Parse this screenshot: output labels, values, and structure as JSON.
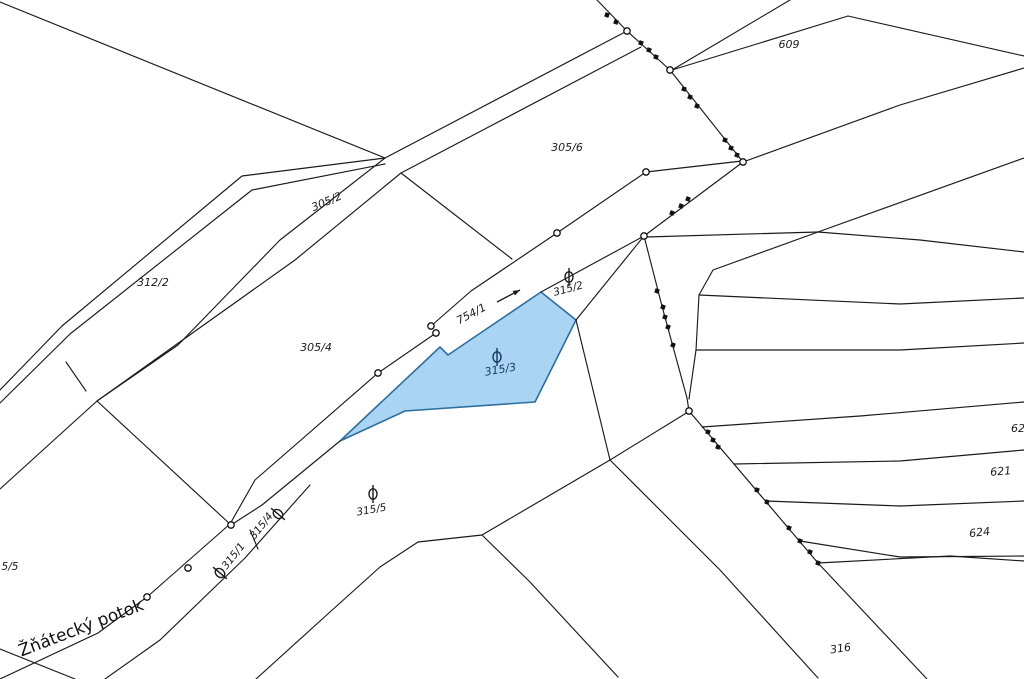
{
  "map": {
    "title": "cadastral-map",
    "background": "#ffffff",
    "line_color": "#1a1a1a",
    "highlight_parcel": {
      "id": "315/3",
      "fill": "#a9d4f3",
      "stroke": "#2e6e9e",
      "polygon": [
        [
          340,
          441
        ],
        [
          440,
          347
        ],
        [
          448,
          355
        ],
        [
          541,
          292
        ],
        [
          576,
          320
        ],
        [
          535,
          402
        ],
        [
          405,
          411
        ]
      ]
    },
    "lines": [
      {
        "points": [
          [
            0,
            2
          ],
          [
            385,
            158
          ]
        ]
      },
      {
        "points": [
          [
            0,
            390
          ],
          [
            62,
            326
          ],
          [
            242,
            176
          ],
          [
            385,
            158
          ]
        ]
      },
      {
        "points": [
          [
            0,
            403
          ],
          [
            70,
            334
          ],
          [
            252,
            190
          ],
          [
            385,
            164
          ]
        ]
      },
      {
        "points": [
          [
            66,
            362
          ],
          [
            86,
            391
          ]
        ]
      },
      {
        "points": [
          [
            627,
            31
          ],
          [
            385,
            158
          ],
          [
            280,
            240
          ],
          [
            178,
            345
          ],
          [
            97,
            401
          ],
          [
            0,
            489
          ]
        ]
      },
      {
        "points": [
          [
            641,
            47
          ],
          [
            401,
            173
          ],
          [
            295,
            260
          ],
          [
            97,
            401
          ]
        ]
      },
      {
        "points": [
          [
            97,
            401
          ],
          [
            231,
            525
          ]
        ]
      },
      {
        "points": [
          [
            401,
            173
          ],
          [
            512,
            259
          ]
        ]
      },
      {
        "points": [
          [
            742,
            161
          ],
          [
            646,
            172
          ],
          [
            557,
            233
          ],
          [
            471,
            291
          ],
          [
            431,
            326
          ]
        ]
      },
      {
        "points": [
          [
            436,
            333
          ],
          [
            378,
            373
          ],
          [
            255,
            480
          ],
          [
            230,
            524
          ]
        ]
      },
      {
        "points": [
          [
            230,
            524
          ],
          [
            147,
            597
          ],
          [
            98,
            633
          ],
          [
            0,
            679
          ]
        ]
      },
      {
        "points": [
          [
            644,
            236
          ],
          [
            541,
            292
          ]
        ]
      },
      {
        "points": [
          [
            340,
            441
          ],
          [
            262,
            505
          ],
          [
            231,
            525
          ]
        ]
      },
      {
        "points": [
          [
            576,
            320
          ],
          [
            644,
            236
          ]
        ]
      },
      {
        "points": [
          [
            576,
            320
          ],
          [
            610,
            460
          ]
        ]
      },
      {
        "points": [
          [
            688,
            412
          ],
          [
            610,
            460
          ],
          [
            482,
            535
          ],
          [
            418,
            542
          ],
          [
            380,
            567
          ],
          [
            330,
            612
          ],
          [
            256,
            679
          ]
        ]
      },
      {
        "points": [
          [
            482,
            535
          ],
          [
            530,
            582
          ],
          [
            618,
            677
          ]
        ]
      },
      {
        "points": [
          [
            610,
            460
          ],
          [
            720,
            570
          ],
          [
            818,
            678
          ]
        ]
      },
      {
        "points": [
          [
            597,
            0
          ],
          [
            627,
            31
          ],
          [
            670,
            70
          ],
          [
            743,
            162
          ]
        ]
      },
      {
        "points": [
          [
            743,
            162
          ],
          [
            644,
            236
          ]
        ]
      },
      {
        "points": [
          [
            644,
            236
          ],
          [
            663,
            310
          ],
          [
            687,
            398
          ],
          [
            689,
            411
          ]
        ]
      },
      {
        "points": [
          [
            689,
            411
          ],
          [
            818,
            563
          ]
        ]
      },
      {
        "points": [
          [
            818,
            563
          ],
          [
            927,
            679
          ]
        ]
      },
      {
        "points": [
          [
            672,
            70
          ],
          [
            790,
            0
          ]
        ]
      },
      {
        "points": [
          [
            672,
            70
          ],
          [
            848,
            16
          ],
          [
            1024,
            56
          ]
        ]
      },
      {
        "points": [
          [
            743,
            162
          ],
          [
            900,
            105
          ],
          [
            1024,
            68
          ]
        ]
      },
      {
        "points": [
          [
            646,
            237
          ],
          [
            818,
            232
          ],
          [
            1024,
            158
          ]
        ]
      },
      {
        "points": [
          [
            818,
            232
          ],
          [
            920,
            240
          ],
          [
            1024,
            252
          ]
        ]
      },
      {
        "points": [
          [
            818,
            232
          ],
          [
            713,
            270
          ],
          [
            699,
            295
          ],
          [
            696,
            350
          ],
          [
            689,
            399
          ]
        ]
      },
      {
        "points": [
          [
            699,
            295
          ],
          [
            900,
            304
          ],
          [
            1024,
            298
          ]
        ]
      },
      {
        "points": [
          [
            696,
            350
          ],
          [
            900,
            350
          ],
          [
            1024,
            343
          ]
        ]
      },
      {
        "points": [
          [
            702,
            427
          ],
          [
            860,
            416
          ],
          [
            1024,
            402
          ]
        ]
      },
      {
        "points": [
          [
            734,
            464
          ],
          [
            900,
            461
          ],
          [
            1024,
            450
          ]
        ]
      },
      {
        "points": [
          [
            766,
            501
          ],
          [
            900,
            506
          ],
          [
            1024,
            501
          ]
        ]
      },
      {
        "points": [
          [
            800,
            541
          ],
          [
            900,
            557
          ],
          [
            1024,
            556
          ]
        ]
      },
      {
        "points": [
          [
            818,
            563
          ],
          [
            950,
            556
          ],
          [
            1024,
            561
          ]
        ]
      },
      {
        "points": [
          [
            0,
            649
          ],
          [
            75,
            679
          ]
        ]
      },
      {
        "points": [
          [
            310,
            485
          ],
          [
            245,
            558
          ],
          [
            160,
            640
          ],
          [
            105,
            679
          ]
        ]
      },
      {
        "points": [
          [
            250,
            530
          ],
          [
            258,
            549
          ]
        ]
      }
    ],
    "boundary_dots": [
      [
        607,
        15
      ],
      [
        616,
        22
      ],
      [
        641,
        43
      ],
      [
        649,
        50
      ],
      [
        656,
        57
      ],
      [
        684,
        89
      ],
      [
        690,
        97
      ],
      [
        697,
        106
      ],
      [
        725,
        140
      ],
      [
        731,
        148
      ],
      [
        737,
        155
      ],
      [
        688,
        199
      ],
      [
        681,
        206
      ],
      [
        672,
        213
      ],
      [
        657,
        291
      ],
      [
        663,
        307
      ],
      [
        665,
        317
      ],
      [
        668,
        327
      ],
      [
        673,
        345
      ],
      [
        708,
        432
      ],
      [
        713,
        440
      ],
      [
        718,
        447
      ],
      [
        757,
        490
      ],
      [
        767,
        502
      ],
      [
        789,
        528
      ],
      [
        800,
        541
      ],
      [
        810,
        552
      ],
      [
        818,
        563
      ]
    ],
    "vertex_circles": [
      [
        627,
        31
      ],
      [
        670,
        70
      ],
      [
        743,
        162
      ],
      [
        646,
        172
      ],
      [
        557,
        233
      ],
      [
        644,
        236
      ],
      [
        689,
        411
      ],
      [
        431,
        326
      ],
      [
        436,
        333
      ],
      [
        378,
        373
      ],
      [
        231,
        525
      ],
      [
        188,
        568
      ],
      [
        147,
        597
      ]
    ],
    "symbols": [
      {
        "name": "orchard-symbol",
        "x": 569,
        "y": 277,
        "rot": 0,
        "color": "#1a1a1a"
      },
      {
        "name": "orchard-symbol",
        "x": 497,
        "y": 357,
        "rot": 0,
        "color": "#15365f"
      },
      {
        "name": "orchard-symbol",
        "x": 373,
        "y": 494,
        "rot": 0,
        "color": "#1a1a1a"
      },
      {
        "name": "orchard-symbol",
        "x": 278,
        "y": 514,
        "rot": -50,
        "color": "#1a1a1a"
      },
      {
        "name": "orchard-symbol",
        "x": 220,
        "y": 573,
        "rot": -50,
        "color": "#1a1a1a"
      }
    ],
    "labels": [
      {
        "text": "305/6",
        "x": 567,
        "y": 151,
        "rot": 0,
        "size": 11,
        "color": "#1a1a1a",
        "italic": true
      },
      {
        "text": "305/2",
        "x": 328,
        "y": 205,
        "rot": -23,
        "size": 11,
        "color": "#1a1a1a",
        "italic": true
      },
      {
        "text": "312/2",
        "x": 153,
        "y": 286,
        "rot": 0,
        "size": 11,
        "color": "#1a1a1a",
        "italic": true
      },
      {
        "text": "305/4",
        "x": 316,
        "y": 351,
        "rot": 0,
        "size": 11,
        "color": "#1a1a1a",
        "italic": true
      },
      {
        "text": "754/1",
        "x": 473,
        "y": 317,
        "rot": -28,
        "size": 11,
        "color": "#1a1a1a",
        "italic": true
      },
      {
        "text": "315/2",
        "x": 569,
        "y": 292,
        "rot": -15,
        "size": 10.5,
        "color": "#1a1a1a",
        "italic": true
      },
      {
        "text": "315/3",
        "x": 501,
        "y": 373,
        "rot": -10,
        "size": 11,
        "color": "#15365f",
        "italic": true
      },
      {
        "text": "315/5",
        "x": 372,
        "y": 513,
        "rot": -10,
        "size": 10.5,
        "color": "#1a1a1a",
        "italic": true
      },
      {
        "text": "315/4",
        "x": 264,
        "y": 528,
        "rot": -52,
        "size": 10.5,
        "color": "#1a1a1a",
        "italic": true
      },
      {
        "text": "315/1",
        "x": 236,
        "y": 558,
        "rot": -52,
        "size": 10.5,
        "color": "#1a1a1a",
        "italic": true
      },
      {
        "text": "609",
        "x": 789,
        "y": 48,
        "rot": 0,
        "size": 11,
        "color": "#1a1a1a",
        "italic": true
      },
      {
        "text": "62",
        "x": 1018,
        "y": 432,
        "rot": 0,
        "size": 11,
        "color": "#1a1a1a",
        "italic": true
      },
      {
        "text": "621",
        "x": 1001,
        "y": 475,
        "rot": -5,
        "size": 11,
        "color": "#1a1a1a",
        "italic": true
      },
      {
        "text": "624",
        "x": 980,
        "y": 536,
        "rot": -7,
        "size": 11,
        "color": "#1a1a1a",
        "italic": true
      },
      {
        "text": "316",
        "x": 841,
        "y": 652,
        "rot": -8,
        "size": 11,
        "color": "#1a1a1a",
        "italic": true
      },
      {
        "text": "5/5",
        "x": 10,
        "y": 570,
        "rot": 0,
        "size": 10.5,
        "color": "#1a1a1a",
        "italic": true
      },
      {
        "text": "Žňátecký potok",
        "x": 83,
        "y": 633,
        "rot": -21,
        "size": 17,
        "color": "#111111",
        "italic": false
      }
    ],
    "arrow": {
      "x1": 497,
      "y1": 302,
      "x2": 520,
      "y2": 290,
      "color": "#1a1a1a"
    }
  }
}
